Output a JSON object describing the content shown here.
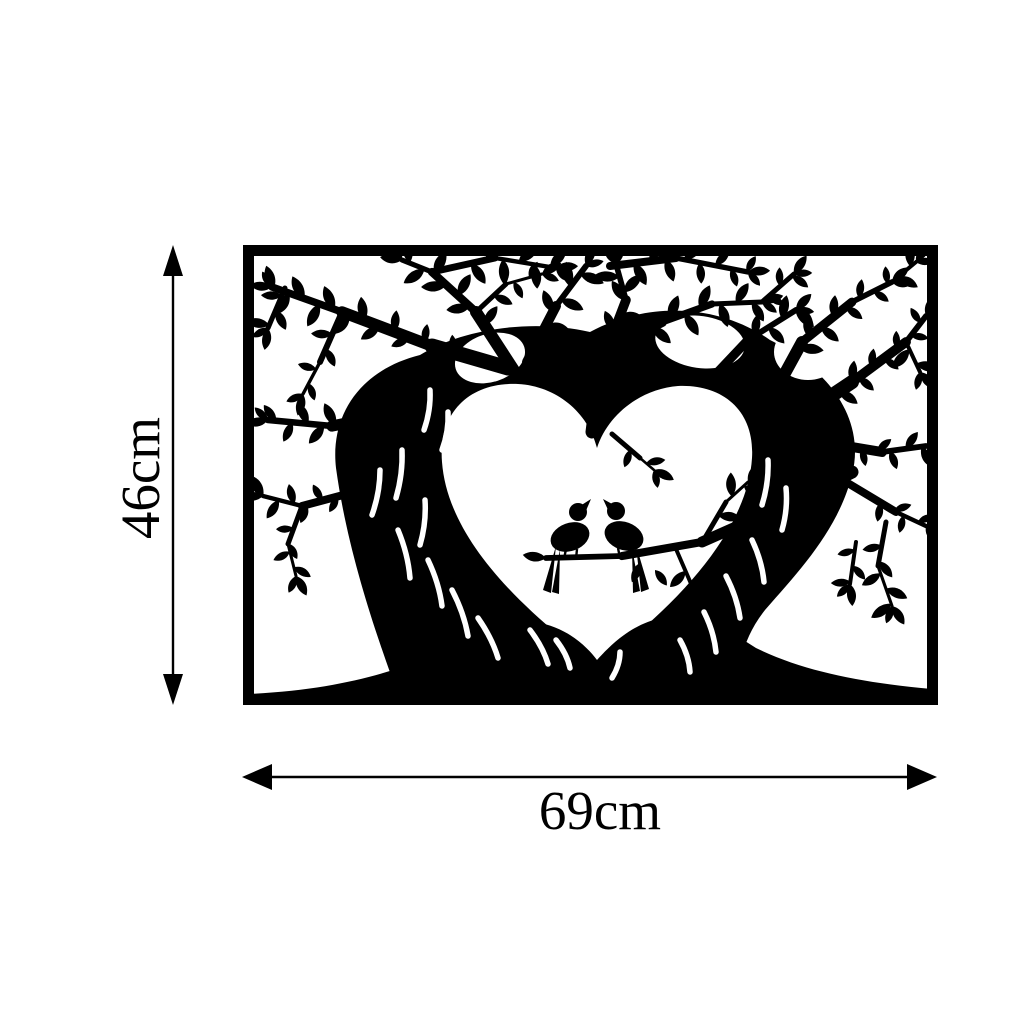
{
  "product_diagram": {
    "artwork": {
      "title": "heart-tree-with-love-birds-wall-art",
      "description": "Black silhouette wall art: two trees whose trunks form a heart, with two birds perched on a branch inside the heart",
      "artwork_color": "#000000",
      "background_color": "#ffffff"
    },
    "dimensions": {
      "height": {
        "label": "46cm"
      },
      "width": {
        "label": "69cm"
      }
    }
  }
}
